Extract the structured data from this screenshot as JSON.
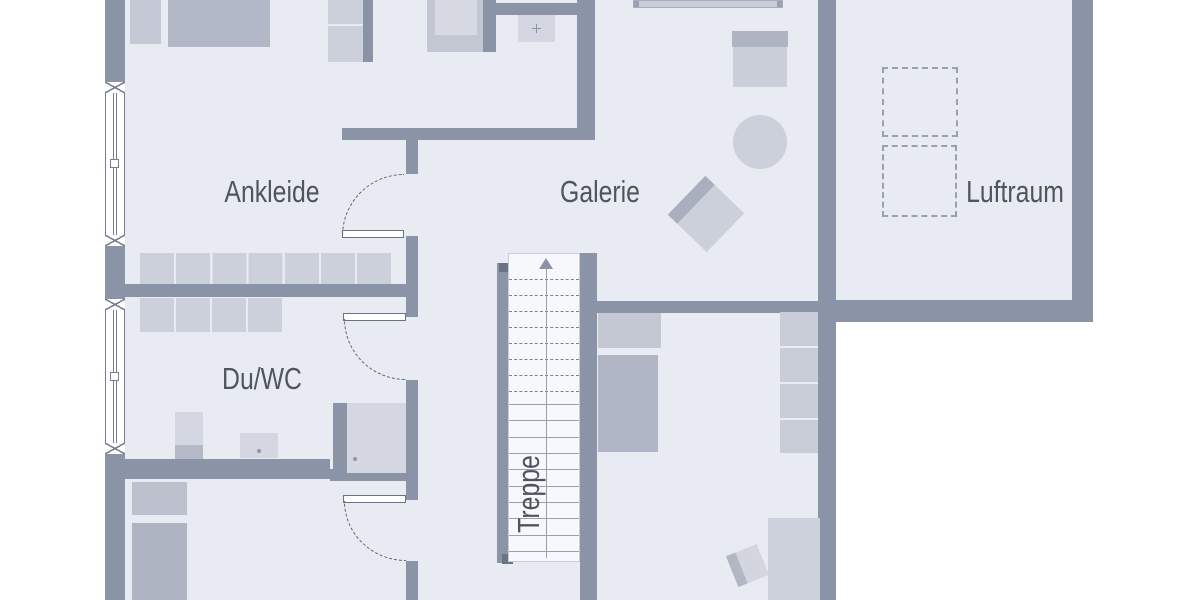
{
  "rooms": [
    {
      "id": "ankleide",
      "label": "Ankleide"
    },
    {
      "id": "galerie",
      "label": "Galerie"
    },
    {
      "id": "luftraum",
      "label": "Luftraum"
    },
    {
      "id": "du-wc",
      "label": "Du/WC"
    },
    {
      "id": "treppe",
      "label": "Treppe"
    }
  ],
  "colors": {
    "wall": "#8b94a7",
    "walldark": "#6a7382",
    "floor": "#e9ebf2",
    "outside": "#ffffff",
    "stairbg": "#f7f8fb",
    "line": "#9aa1ae",
    "dash": "#5b6170",
    "text": "#4f5560",
    "frame": "#767f8f",
    "furn1": "#ccd0db",
    "furn2": "#c5c9d5",
    "furn3": "#b2b8c7",
    "furn4": "#d4d7e1"
  }
}
